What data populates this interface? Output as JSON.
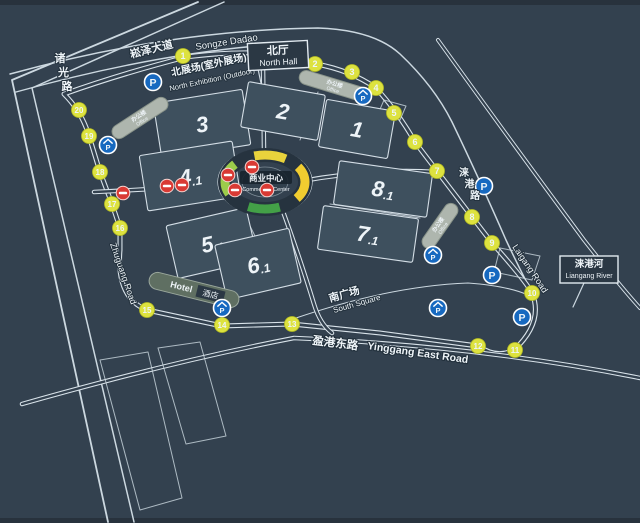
{
  "map": {
    "roads": {
      "songze_zh": "崧泽大道",
      "songze_en": "Songze Dadao",
      "zhuguang_zh": "诸光路",
      "zhuguang_en": "Zhuguang Road",
      "laigang_zh": "涞港路",
      "laigang_en": "Laigang Road",
      "yinggang_zh": "盈港东路",
      "yinggang_en": "Yinggang East Road"
    },
    "river": {
      "zh": "涞港河",
      "en": "Liangang River"
    },
    "north_hall": {
      "zh": "北厅",
      "en": "North Hall"
    },
    "north_exhibition": {
      "zh": "北展场(室外展场)",
      "en": "North Exhibition (Outdoor)"
    },
    "south_square": {
      "zh": "南广场",
      "en": "South Square"
    },
    "commercial_center": {
      "zh": "商业中心",
      "en": "Commercial Center"
    },
    "halls": [
      {
        "label": "3"
      },
      {
        "label": "4.1"
      },
      {
        "label": "2"
      },
      {
        "label": "1"
      },
      {
        "label": "8.1"
      },
      {
        "label": "7.1"
      },
      {
        "label": "5.1"
      },
      {
        "label": "6.1"
      }
    ],
    "gates": [
      "1",
      "2",
      "3",
      "4",
      "5",
      "6",
      "7",
      "8",
      "9",
      "10",
      "11",
      "12",
      "13",
      "14",
      "15",
      "16",
      "17",
      "18",
      "19",
      "20"
    ],
    "buildings": [
      {
        "kind": "office",
        "zh": "办公楼",
        "en": "Office"
      },
      {
        "kind": "office",
        "zh": "办公楼",
        "en": "Office"
      },
      {
        "kind": "office",
        "zh": "办公楼",
        "en": "Office"
      },
      {
        "kind": "hotel",
        "zh": "酒店",
        "en": "Hotel"
      }
    ],
    "icons": {
      "parking_label": "P",
      "parking_plain_count": 4,
      "parking_covered_count": 5,
      "no_entry_count": 7
    },
    "colors": {
      "background": "#33414f",
      "road_line": "#d9e3ea",
      "hall_fill": "#3e505e",
      "gate_fill": "#dde23f",
      "parking_fill": "#1769c0",
      "no_entry_fill": "#d93a34",
      "ring_yellow": "#f1cd30",
      "ring_green": "#43a047",
      "ring_light_green": "#9ccc4a"
    }
  }
}
